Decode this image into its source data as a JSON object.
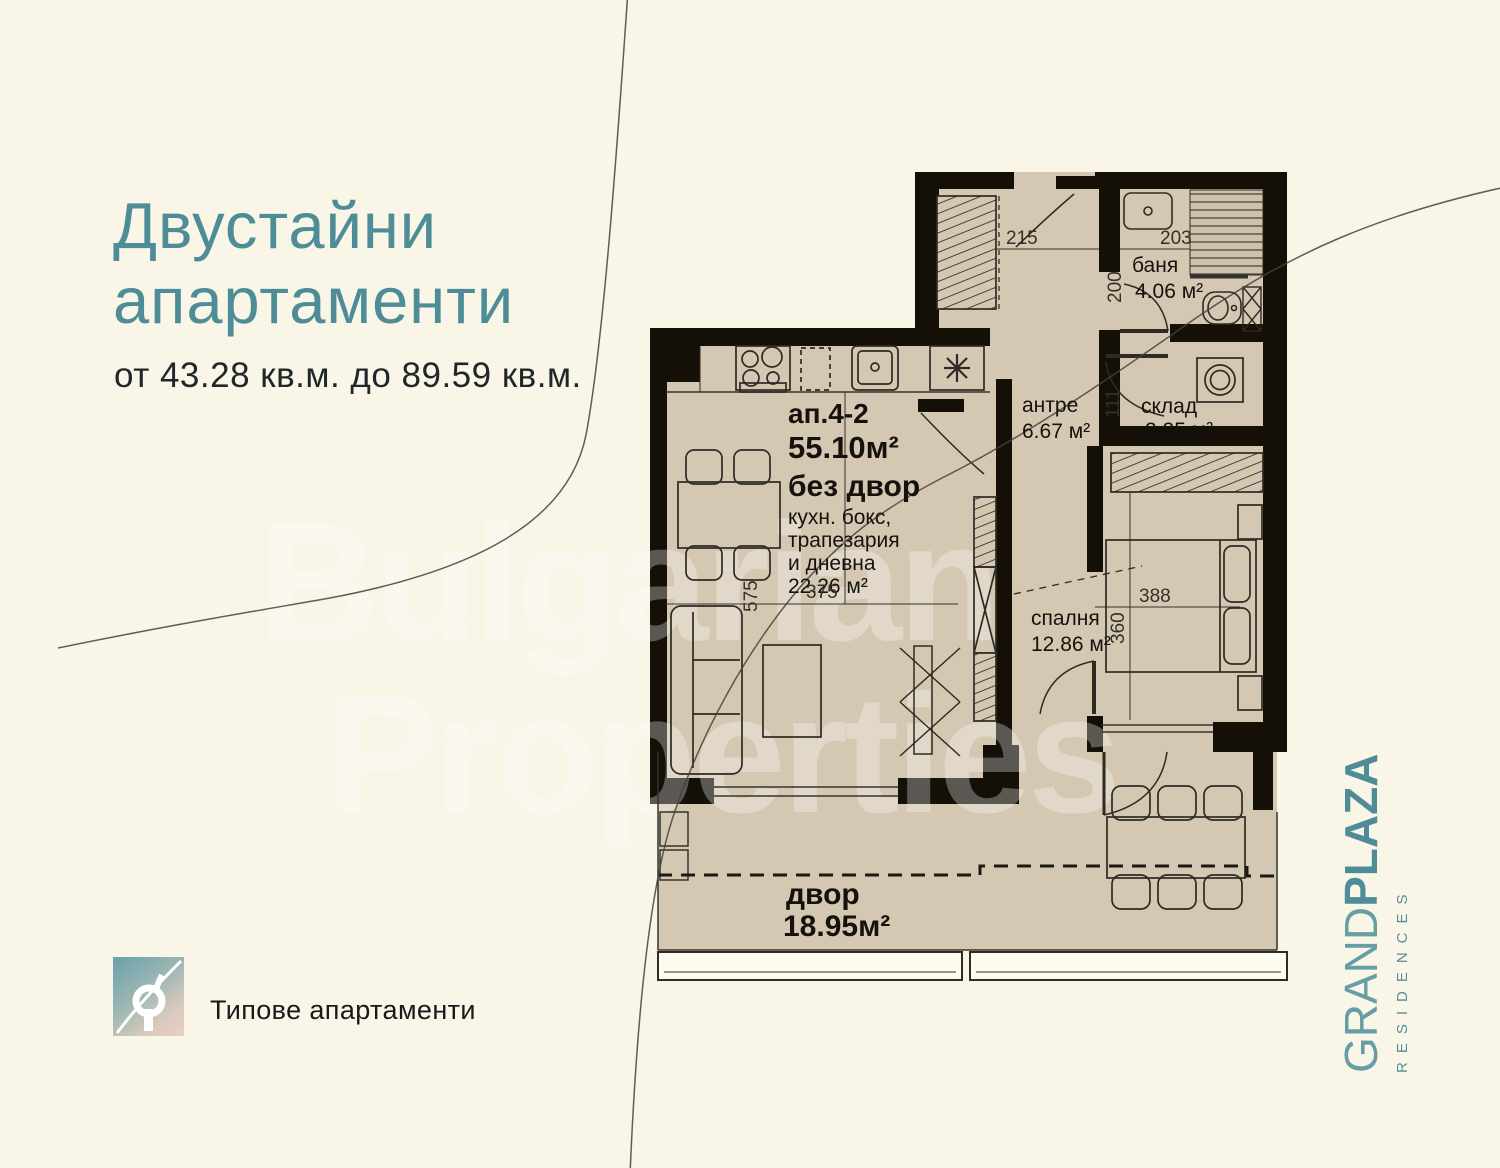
{
  "header": {
    "title_line1": "Двустайни",
    "title_line2": "апартаменти",
    "subtitle": "от 43.28 кв.м. до 89.59 кв.м.",
    "accent_color": "#4e8d98"
  },
  "watermark": {
    "line1": "Bulgarian",
    "line2": "Properties"
  },
  "brand": {
    "name_light": "GRAND",
    "name_bold": "PLAZA",
    "sub": "RESIDENCES"
  },
  "footer": {
    "caption": "Типове апартаменти"
  },
  "plan": {
    "apartment": {
      "id": "ап.4-2",
      "area": "55.10м²",
      "note": "без двор"
    },
    "rooms": {
      "living": {
        "name_lines": [
          "кухн. бокс,",
          "трапезария",
          "и дневна"
        ],
        "area": "22.26 м²"
      },
      "hallway": {
        "name": "антре",
        "area": "6.67 м²"
      },
      "bathroom": {
        "name": "баня",
        "area": "4.06 м²"
      },
      "storage": {
        "name": "склад",
        "area": "2.25 м²"
      },
      "bedroom": {
        "name": "спалня",
        "area": "12.86 м²"
      },
      "yard": {
        "name": "двор",
        "area": "18.95м²"
      }
    },
    "dimensions": {
      "entry_width": "215",
      "bath_width": "203",
      "bath_depth": "200",
      "storage_width": "111",
      "living_depth": "575",
      "living_width": "375",
      "bedroom_width": "388",
      "bedroom_depth": "360"
    },
    "colors": {
      "floor": "#d5c8b2",
      "wall": "#141008",
      "line": "#2e2a24"
    }
  }
}
